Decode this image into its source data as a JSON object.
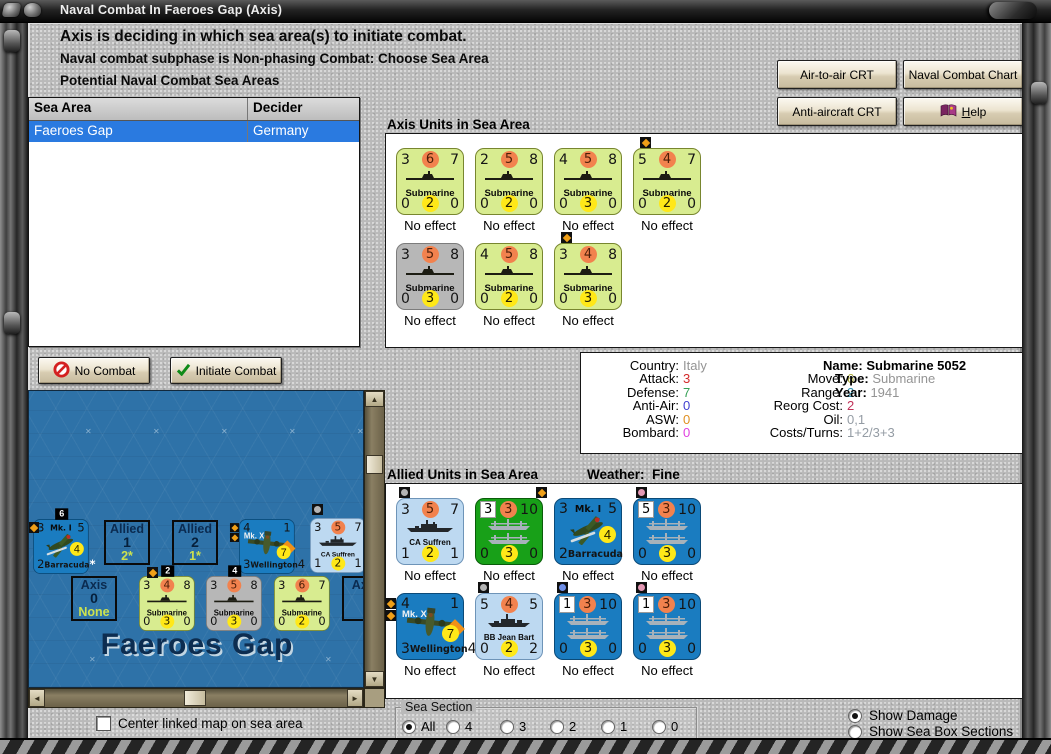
{
  "window": {
    "title": "Naval Combat In Faeroes Gap (Axis)"
  },
  "header": {
    "line1": "Axis is deciding in which sea area(s) to initiate combat.",
    "line2": "Naval combat subphase is Non-phasing Combat: Choose Sea Area",
    "line3": "Potential Naval Combat Sea Areas"
  },
  "sea_table": {
    "columns": [
      "Sea Area",
      "Decider"
    ],
    "rows": [
      {
        "sea_area": "Faeroes Gap",
        "decider": "Germany",
        "selected": true
      }
    ]
  },
  "toolbar": {
    "air_crt": "Air-to-air CRT",
    "naval_chart": "Naval Combat Chart",
    "aa_crt": "Anti-aircraft CRT",
    "help": "Help"
  },
  "actions": {
    "no_combat": "No Combat",
    "initiate_combat": "Initiate Combat"
  },
  "axis_units": {
    "title": "Axis Units in Sea Area",
    "rows": [
      [
        {
          "kind": "submarine",
          "color": "green",
          "top": [
            "3",
            "6",
            "7"
          ],
          "label": "Submarine",
          "bottom": [
            "0",
            "2",
            "0"
          ],
          "status": "No effect",
          "markers": []
        },
        {
          "kind": "submarine",
          "color": "green",
          "top": [
            "2",
            "5",
            "8"
          ],
          "label": "Submarine",
          "bottom": [
            "0",
            "2",
            "0"
          ],
          "status": "No effect",
          "markers": []
        },
        {
          "kind": "submarine",
          "color": "green",
          "top": [
            "4",
            "5",
            "8"
          ],
          "label": "Submarine",
          "bottom": [
            "0",
            "3",
            "0"
          ],
          "status": "No effect",
          "markers": []
        },
        {
          "kind": "submarine",
          "color": "green",
          "top": [
            "5",
            "4",
            "7"
          ],
          "label": "Submarine",
          "bottom": [
            "0",
            "2",
            "0"
          ],
          "status": "No effect",
          "markers": [
            {
              "color": "orange",
              "pos": "t",
              "shape": "dm"
            }
          ]
        }
      ],
      [
        {
          "kind": "submarine",
          "color": "gray",
          "top": [
            "3",
            "5",
            "8"
          ],
          "label": "Submarine",
          "bottom": [
            "0",
            "3",
            "0"
          ],
          "status": "No effect",
          "markers": []
        },
        {
          "kind": "submarine",
          "color": "green",
          "top": [
            "4",
            "5",
            "8"
          ],
          "label": "Submarine",
          "bottom": [
            "0",
            "2",
            "0"
          ],
          "status": "No effect",
          "markers": []
        },
        {
          "kind": "submarine",
          "color": "green",
          "top": [
            "3",
            "4",
            "8"
          ],
          "label": "Submarine",
          "bottom": [
            "0",
            "3",
            "0"
          ],
          "status": "No effect",
          "markers": [
            {
              "color": "orange",
              "pos": "t",
              "shape": "dm"
            }
          ]
        }
      ]
    ]
  },
  "unit_info": {
    "country_label": "Country:",
    "country": "Italy",
    "stats_left": [
      {
        "label": "Attack:",
        "value": "3",
        "color": "#d42a2a"
      },
      {
        "label": "Defense:",
        "value": "7",
        "color": "#35a055"
      },
      {
        "label": "Anti-Air:",
        "value": "0",
        "color": "#4040d0"
      },
      {
        "label": "ASW:",
        "value": "0",
        "color": "#e09020"
      },
      {
        "label": "Bombard:",
        "value": "0",
        "color": "#e040e0"
      }
    ],
    "stats_mid": [
      {
        "label": "Move:",
        "value": "6",
        "color": "#a8a836"
      },
      {
        "label": "Range:",
        "value": "2",
        "color": "#3092b0"
      },
      {
        "label": "Reorg Cost:",
        "value": "2",
        "color": "#c03058"
      },
      {
        "label": "Oil:",
        "value": "0,1",
        "color": "#949ca4"
      },
      {
        "label": "Costs/Turns:",
        "value": "1+2/3+3",
        "color": "#949ca4"
      }
    ],
    "name_label": "Name:",
    "name": "Submarine 5052",
    "type_label": "Type:",
    "type": "Submarine",
    "year_label": "Year:",
    "year": "1941"
  },
  "allied_units": {
    "title": "Allied Units in Sea Area",
    "weather_label": "Weather:",
    "weather": "Fine",
    "rows": [
      [
        {
          "kind": "cruiser",
          "color": "lblue",
          "top": [
            "3",
            "5",
            "7"
          ],
          "label": "CA Suffren",
          "bottom": [
            "1",
            "2",
            "1"
          ],
          "status": "No effect",
          "markers": [
            {
              "color": "gray",
              "pos": "tl",
              "shape": "dot"
            }
          ]
        },
        {
          "kind": "convoy",
          "color": "grn2",
          "top": [
            "3",
            "3",
            "10"
          ],
          "bottom": [
            "0",
            "3",
            "0"
          ],
          "status": "No effect",
          "markers": [
            {
              "color": "orange",
              "pos": "tr",
              "shape": "dm"
            }
          ]
        },
        {
          "kind": "barracuda",
          "color": "blue",
          "top": [
            "3",
            "Mk. I",
            "5"
          ],
          "circle": "4",
          "bottom": [
            "2",
            "Barracuda",
            "*"
          ],
          "status": "No effect",
          "markers": []
        },
        {
          "kind": "convoy",
          "color": "blue",
          "top": [
            "5",
            "3",
            "10"
          ],
          "bottom": [
            "0",
            "3",
            "0"
          ],
          "status": "No effect",
          "markers": [
            {
              "color": "pink",
              "pos": "tl",
              "shape": "dot"
            }
          ]
        }
      ],
      [
        {
          "kind": "wellington",
          "color": "blue",
          "top": [
            "4",
            "",
            "1"
          ],
          "mark": "Mk. X",
          "circle": "7",
          "bottom": [
            "3",
            "Wellington",
            "4"
          ],
          "status": "No effect",
          "markers": [
            {
              "color": "orange",
              "pos": "l",
              "shape": "dm"
            },
            {
              "color": "orange",
              "pos": "l",
              "shape": "dm"
            }
          ]
        },
        {
          "kind": "battleship",
          "color": "lblue",
          "top": [
            "5",
            "4",
            "5"
          ],
          "label": "BB Jean Bart",
          "bottom": [
            "0",
            "2",
            "2"
          ],
          "status": "No effect",
          "markers": [
            {
              "color": "gray",
              "pos": "tl",
              "shape": "dot"
            }
          ]
        },
        {
          "kind": "convoy",
          "color": "blue",
          "top": [
            "1",
            "3",
            "10"
          ],
          "bottom": [
            "0",
            "3",
            "0"
          ],
          "status": "No effect",
          "markers": [
            {
              "color": "blue",
              "pos": "tl",
              "shape": "dot"
            }
          ]
        },
        {
          "kind": "convoy",
          "color": "blue",
          "top": [
            "1",
            "3",
            "10"
          ],
          "bottom": [
            "0",
            "3",
            "0"
          ],
          "status": "No effect",
          "markers": [
            {
              "color": "pink",
              "pos": "tl",
              "shape": "dot"
            }
          ]
        }
      ]
    ]
  },
  "map": {
    "title": "Faeroes Gap",
    "boxes": [
      {
        "side": "Allied",
        "count": "1",
        "value": "2*"
      },
      {
        "side": "Allied",
        "count": "2",
        "value": "1*"
      },
      {
        "side": "Axis",
        "count": "0",
        "value": "None"
      },
      {
        "side": "Axis",
        "count": "",
        "value": ""
      }
    ],
    "counters": [
      {
        "kind": "barracuda",
        "color": "blue",
        "top": [
          "3",
          "Mk. I",
          "5"
        ],
        "circle": "4",
        "bottom": [
          "2",
          "Barracuda",
          "*"
        ],
        "badge": "6",
        "markers": []
      },
      {
        "kind": "wellington",
        "color": "blue",
        "top": [
          "4",
          "",
          "1"
        ],
        "mark": "Mk. X",
        "circle": "7",
        "bottom": [
          "3",
          "Wellington",
          "4"
        ],
        "markers": [
          {
            "color": "orange",
            "pos": "l",
            "shape": "dm"
          },
          {
            "color": "orange",
            "pos": "l",
            "shape": "dm"
          }
        ]
      },
      {
        "kind": "cruiser",
        "color": "lblue",
        "top": [
          "3",
          "5",
          "7"
        ],
        "label": "CA Suffren",
        "bottom": [
          "1",
          "2",
          "1"
        ],
        "markers": []
      },
      {
        "kind": "submarine",
        "color": "green",
        "top": [
          "3",
          "4",
          "8"
        ],
        "label": "Submarine",
        "bottom": [
          "0",
          "3",
          "0"
        ],
        "badge": "2",
        "markers": []
      },
      {
        "kind": "submarine",
        "color": "gray",
        "top": [
          "3",
          "5",
          "8"
        ],
        "label": "Submarine",
        "bottom": [
          "0",
          "3",
          "0"
        ],
        "badge": "4",
        "markers": []
      },
      {
        "kind": "submarine",
        "color": "green",
        "top": [
          "3",
          "6",
          "7"
        ],
        "label": "Submarine",
        "bottom": [
          "0",
          "2",
          "0"
        ],
        "markers": []
      }
    ]
  },
  "footer": {
    "center_checkbox": {
      "label": "Center linked map on sea area",
      "checked": false
    },
    "sea_section": {
      "label": "Sea Section",
      "options": [
        "All",
        "4",
        "3",
        "2",
        "1",
        "0"
      ],
      "selected": "All"
    },
    "display": {
      "options": [
        "Show Damage",
        "Show Sea Box Sections"
      ],
      "selected": "Show Damage"
    }
  }
}
